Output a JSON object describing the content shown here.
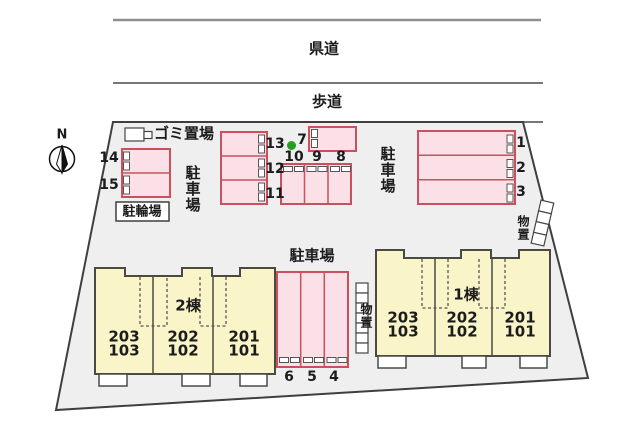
{
  "roads": {
    "prefectural_road": "県道",
    "sidewalk": "歩道"
  },
  "compass": {
    "north_label": "N"
  },
  "areas": {
    "garbage_area": "ゴミ置場",
    "bicycle_parking": "駐輪場",
    "parking_lot_left": "駐車場",
    "parking_lot_right": "駐車場",
    "parking_lot_bottom": "駐車場",
    "storage_right": "物置",
    "storage_left": "物置"
  },
  "parking_spaces": [
    "1",
    "2",
    "3",
    "4",
    "5",
    "6",
    "7",
    "8",
    "9",
    "10",
    "11",
    "12",
    "13",
    "14",
    "15"
  ],
  "buildings": [
    {
      "name": "2棟",
      "units": [
        {
          "upper": "203",
          "lower": "103"
        },
        {
          "upper": "202",
          "lower": "102"
        },
        {
          "upper": "201",
          "lower": "101"
        }
      ]
    },
    {
      "name": "1棟",
      "units": [
        {
          "upper": "203",
          "lower": "103"
        },
        {
          "upper": "202",
          "lower": "102"
        },
        {
          "upper": "201",
          "lower": "101"
        }
      ]
    }
  ],
  "colors": {
    "parking_fill": "#fbe0e8",
    "parking_border": "#c9505c",
    "building_fill": "#faf4c9",
    "building_outline": "#4a4a45",
    "site_fill": "#f0eff0",
    "vacancy_marker_green": "#22a022"
  }
}
